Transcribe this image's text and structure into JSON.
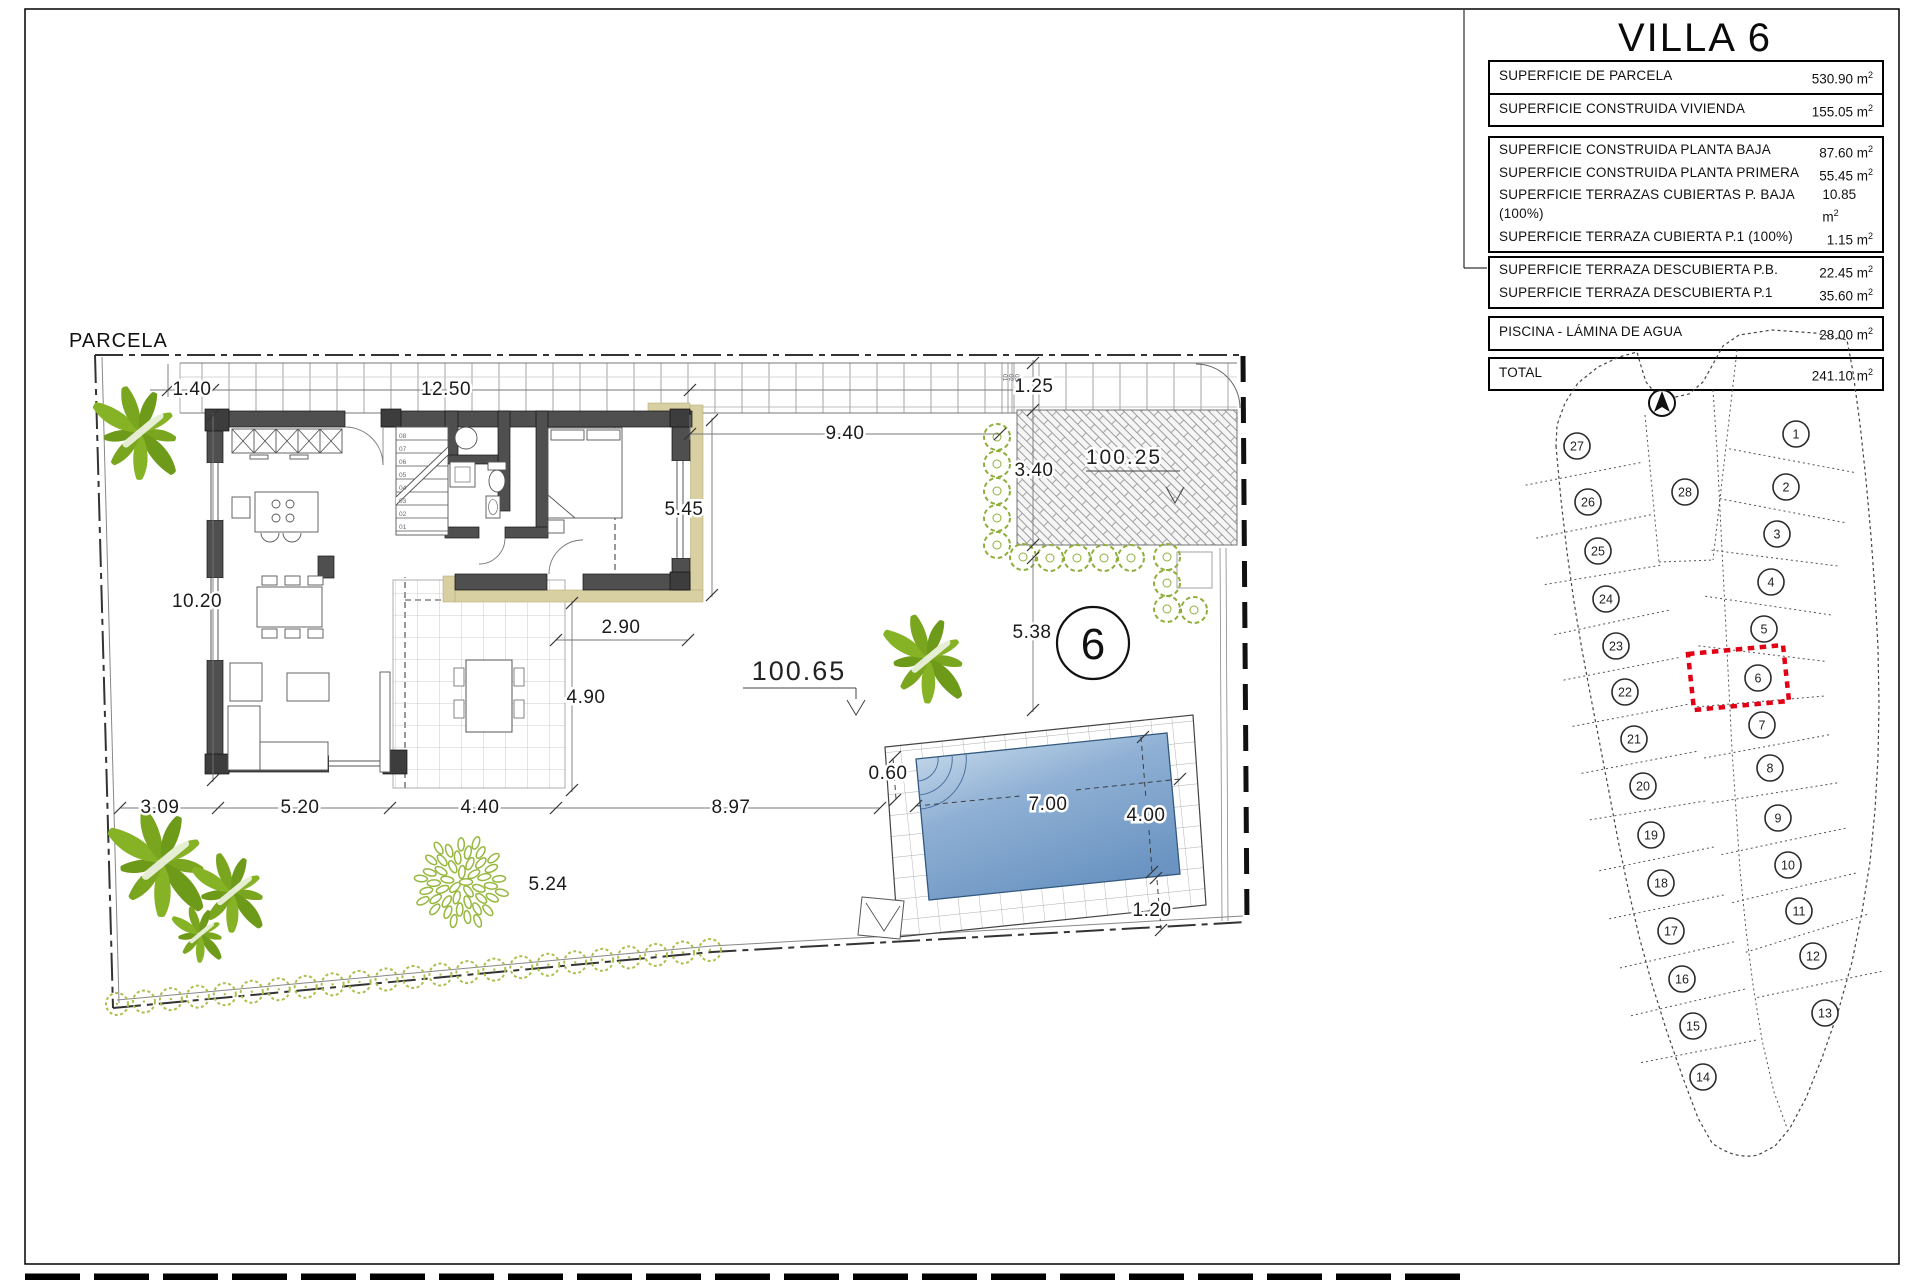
{
  "title": "VILLA 6",
  "plan": {
    "parcela_label": "PARCELA",
    "lot_marker": "6",
    "level_labels": [
      {
        "t": "100.65",
        "x": 799,
        "y": 680,
        "s": 27
      },
      {
        "t": "100.25",
        "x": 1124,
        "y": 464,
        "s": 21
      }
    ],
    "dimensions": [
      {
        "t": "1.40",
        "x": 192,
        "y": 389
      },
      {
        "t": "12.50",
        "x": 446,
        "y": 389
      },
      {
        "t": "9.40",
        "x": 845,
        "y": 433
      },
      {
        "t": "1.25",
        "x": 1034,
        "y": 386
      },
      {
        "t": "3.40",
        "x": 1034,
        "y": 470
      },
      {
        "t": "5.45",
        "x": 684,
        "y": 509
      },
      {
        "t": "10.20",
        "x": 197,
        "y": 601
      },
      {
        "t": "2.90",
        "x": 621,
        "y": 627
      },
      {
        "t": "5.38",
        "x": 1032,
        "y": 632
      },
      {
        "t": "3.09",
        "x": 160,
        "y": 807
      },
      {
        "t": "5.20",
        "x": 300,
        "y": 807
      },
      {
        "t": "4.40",
        "x": 480,
        "y": 807
      },
      {
        "t": "8.97",
        "x": 731,
        "y": 807
      },
      {
        "t": "5.24",
        "x": 548,
        "y": 884
      },
      {
        "t": "4.90",
        "x": 586,
        "y": 697
      },
      {
        "t": "0.60",
        "x": 888,
        "y": 773
      },
      {
        "t": "7.00",
        "x": 1048,
        "y": 804
      },
      {
        "t": "4.00",
        "x": 1146,
        "y": 815
      },
      {
        "t": "1.20",
        "x": 1152,
        "y": 910
      }
    ],
    "stairs_steps": [
      "01",
      "02",
      "03",
      "04",
      "05",
      "06",
      "07",
      "08"
    ],
    "walkway_steps": [
      "01",
      "02",
      "03"
    ],
    "landscape": {
      "palms": [
        {
          "x": 140,
          "y": 432,
          "s": 1.0
        },
        {
          "x": 162,
          "y": 862,
          "s": 1.15
        },
        {
          "x": 232,
          "y": 892,
          "s": 0.85
        },
        {
          "x": 200,
          "y": 934,
          "s": 0.6
        },
        {
          "x": 928,
          "y": 658,
          "s": 0.95
        }
      ],
      "shrub": {
        "x": 461,
        "y": 882,
        "r": 44
      },
      "hedge": {
        "x1": 117,
        "y1": 1004,
        "x2": 710,
        "y2": 950,
        "count": 23,
        "r": 11
      },
      "bushes": [
        [
          997,
          437
        ],
        [
          997,
          464
        ],
        [
          997,
          491
        ],
        [
          997,
          518
        ],
        [
          997,
          545
        ],
        [
          1023,
          557
        ],
        [
          1050,
          558
        ],
        [
          1077,
          558
        ],
        [
          1104,
          558
        ],
        [
          1131,
          558
        ],
        [
          1167,
          557
        ],
        [
          1167,
          583
        ],
        [
          1167,
          609
        ],
        [
          1194,
          610
        ]
      ]
    },
    "colors": {
      "wall": "#4f4f4f",
      "tan": "#d8cfa2",
      "pool_light": "#c6d9eb",
      "pool_dark": "#6b94c2",
      "green": "#7aa51e",
      "red": "#e10014"
    }
  },
  "table": {
    "unit": "m",
    "unit_sup": "2",
    "groups": [
      {
        "cls": "g1",
        "rows": [
          {
            "label": "SUPERFICIE DE PARCELA",
            "value": "530.90"
          }
        ]
      },
      {
        "cls": "g2",
        "rows": [
          {
            "label": "SUPERFICIE CONSTRUIDA VIVIENDA",
            "value": "155.05"
          }
        ]
      },
      {
        "cls": "g3",
        "rows": [
          {
            "label": "SUPERFICIE CONSTRUIDA PLANTA BAJA",
            "value": "87.60"
          },
          {
            "label": "SUPERFICIE CONSTRUIDA PLANTA PRIMERA",
            "value": "55.45"
          },
          {
            "label": "SUPERFICIE TERRAZAS CUBIERTAS P. BAJA (100%)",
            "value": "10.85"
          },
          {
            "label": "SUPERFICIE TERRAZA CUBIERTA P.1 (100%)",
            "value": "1.15"
          }
        ]
      },
      {
        "cls": "g4",
        "rows": [
          {
            "label": "SUPERFICIE TERRAZA DESCUBIERTA P.B.",
            "value": "22.45"
          },
          {
            "label": "SUPERFICIE TERRAZA DESCUBIERTA P.1",
            "value": "35.60"
          }
        ]
      },
      {
        "cls": "g5",
        "rows": [
          {
            "label": "PISCINA - LÁMINA DE AGUA",
            "value": "28.00"
          }
        ]
      },
      {
        "cls": "g6",
        "rows": [
          {
            "label": "TOTAL",
            "value": "241.10"
          }
        ]
      }
    ]
  },
  "map": {
    "highlight": "6",
    "red_box": "1688,654 1783,645 1789,701 1694,710",
    "columns": {
      "left": [
        "27",
        "26",
        "25",
        "24",
        "23",
        "22",
        "21",
        "20",
        "19",
        "18",
        "17",
        "16",
        "15",
        "14"
      ],
      "right": [
        "1",
        "2",
        "3",
        "4",
        "5",
        "6",
        "7",
        "8",
        "9",
        "10",
        "11",
        "12",
        "13"
      ]
    },
    "lots": [
      {
        "n": "27",
        "x": 1577,
        "y": 446
      },
      {
        "n": "26",
        "x": 1588,
        "y": 502
      },
      {
        "n": "25",
        "x": 1598,
        "y": 551
      },
      {
        "n": "24",
        "x": 1606,
        "y": 599
      },
      {
        "n": "23",
        "x": 1616,
        "y": 646
      },
      {
        "n": "22",
        "x": 1625,
        "y": 692
      },
      {
        "n": "21",
        "x": 1634,
        "y": 739
      },
      {
        "n": "20",
        "x": 1643,
        "y": 786
      },
      {
        "n": "19",
        "x": 1651,
        "y": 835
      },
      {
        "n": "18",
        "x": 1661,
        "y": 883
      },
      {
        "n": "17",
        "x": 1671,
        "y": 931
      },
      {
        "n": "16",
        "x": 1682,
        "y": 979
      },
      {
        "n": "15",
        "x": 1693,
        "y": 1026
      },
      {
        "n": "14",
        "x": 1703,
        "y": 1077
      },
      {
        "n": "28",
        "x": 1685,
        "y": 492
      },
      {
        "n": "1",
        "x": 1796,
        "y": 434
      },
      {
        "n": "2",
        "x": 1786,
        "y": 487
      },
      {
        "n": "3",
        "x": 1777,
        "y": 534
      },
      {
        "n": "4",
        "x": 1771,
        "y": 582
      },
      {
        "n": "5",
        "x": 1764,
        "y": 629
      },
      {
        "n": "6",
        "x": 1758,
        "y": 678
      },
      {
        "n": "7",
        "x": 1762,
        "y": 725
      },
      {
        "n": "8",
        "x": 1770,
        "y": 768
      },
      {
        "n": "9",
        "x": 1778,
        "y": 818
      },
      {
        "n": "10",
        "x": 1788,
        "y": 865
      },
      {
        "n": "11",
        "x": 1799,
        "y": 911
      },
      {
        "n": "12",
        "x": 1813,
        "y": 956
      },
      {
        "n": "13",
        "x": 1825,
        "y": 1013
      }
    ]
  }
}
